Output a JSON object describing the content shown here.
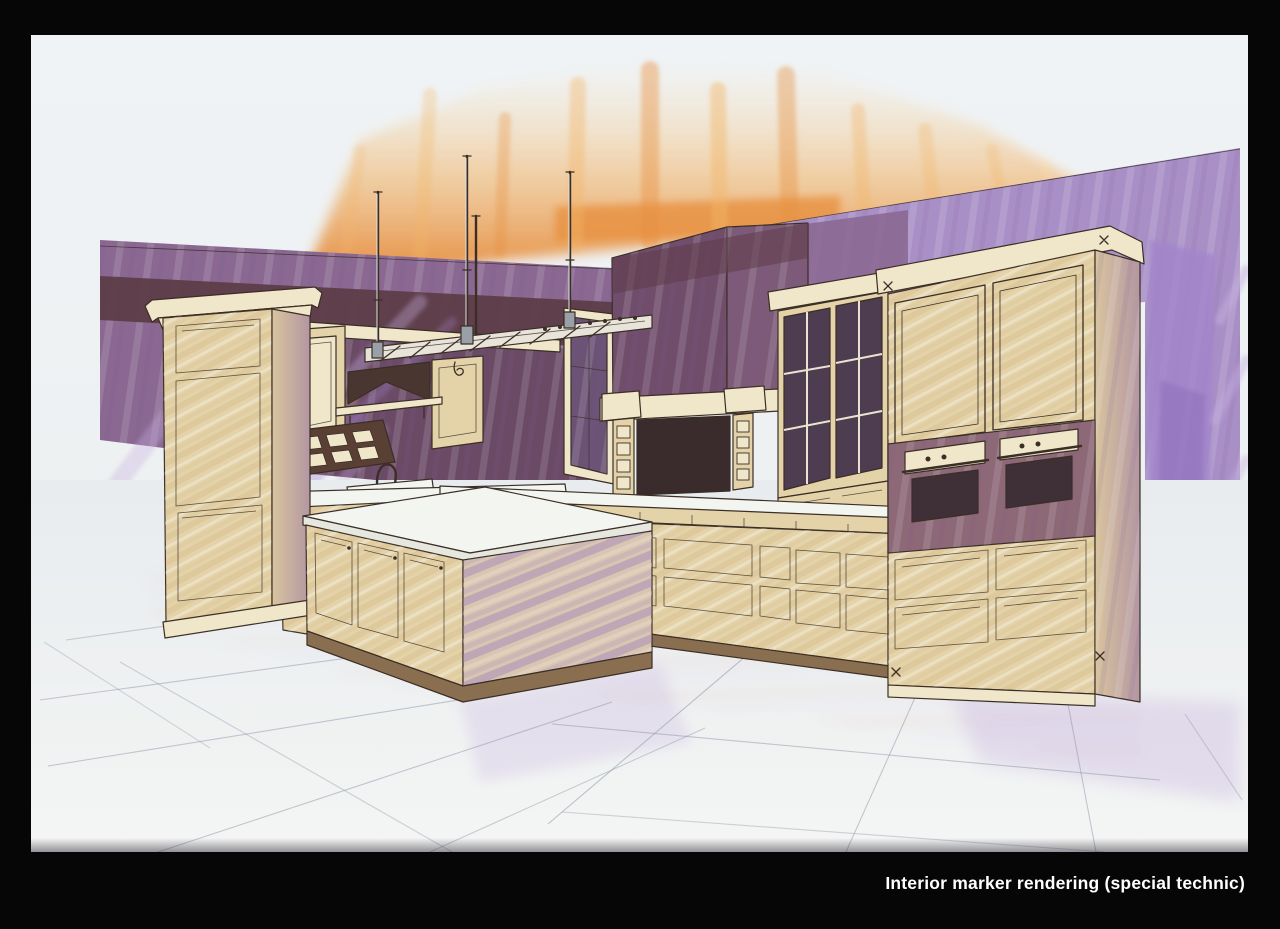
{
  "figure": {
    "caption": "Interior marker rendering (special technic)",
    "medium": "marker rendering on paper",
    "subject": "kitchen interior, two-point perspective",
    "scene_elements": [
      "orange light glow",
      "purple accent walls",
      "tall pantry cabinet",
      "wall cabinets",
      "plate rack",
      "sink and faucet",
      "range hood with mantel",
      "window",
      "glass-door hutch",
      "double wall-oven cabinet",
      "base drawer cabinets",
      "kitchen island",
      "hanging pot rack",
      "tile floor"
    ]
  },
  "palette": {
    "frame_black": "#060606",
    "paper": "#edf1f3",
    "ink": "#3a2e25",
    "glow_core": "#e78f3e",
    "glow_mid": "#f2b569",
    "glow_pale": "#f9d9a4",
    "wall_purple": "#8a6892",
    "wall_maroon": "#5e3d49",
    "wall_plum_dark": "#6b4a66",
    "wall_lilac": "#a88fc6",
    "streak_violet": "#a285cc",
    "streak_lavender": "#c5b0de",
    "cabinet_cream": "#f0e7cb",
    "cabinet_tan": "#e4d2a9",
    "cabinet_shadow": "#c09b64",
    "counter_white": "#f3f5f0",
    "oven_band": "#8d6876",
    "glass_pane": "#4e3c50",
    "hood_opening": "#3a2b2c",
    "floor_line": "#8d96aa",
    "island_face": "#d8c6b3",
    "toe_kick": "#8a6e50",
    "metal": "#9aa0a8"
  }
}
